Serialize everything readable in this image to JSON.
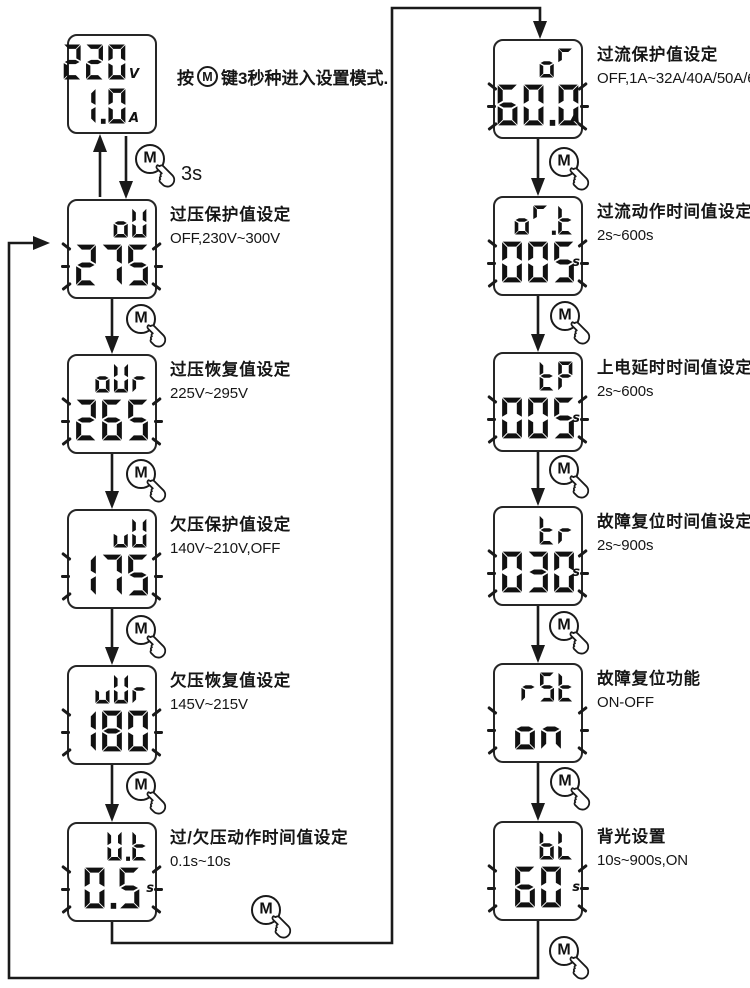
{
  "intro_note": {
    "prefix": "按",
    "m_label": "M",
    "suffix": "键3秒种进入设置模式."
  },
  "hold_time_label": "3s",
  "m_button_label": "M",
  "flow": {
    "home_screen": {
      "voltage": "220",
      "voltage_unit": "V",
      "current": "1.0",
      "current_unit": "A"
    },
    "left_steps": [
      {
        "screen_label": "oU",
        "screen_value": "275",
        "screen_unit": "",
        "blinking": true,
        "title": "过压保护值设定",
        "range": "OFF,230V~300V"
      },
      {
        "screen_label": "oUr",
        "screen_value": "265",
        "screen_unit": "",
        "blinking": true,
        "title": "过压恢复值设定",
        "range": "225V~295V"
      },
      {
        "screen_label": "uU",
        "screen_value": "175",
        "screen_unit": "",
        "blinking": true,
        "title": "欠压保护值设定",
        "range": "140V~210V,OFF"
      },
      {
        "screen_label": "uUr",
        "screen_value": "180",
        "screen_unit": "",
        "blinking": true,
        "title": "欠压恢复值设定",
        "range": "145V~215V"
      },
      {
        "screen_label": "U.t",
        "screen_value": "0.5",
        "screen_unit": "s",
        "blinking": true,
        "title": "过/欠压动作时间值设定",
        "range": "0.1s~10s"
      }
    ],
    "right_steps": [
      {
        "screen_label": "oC",
        "screen_value": "60.0",
        "screen_unit": "A",
        "blinking": true,
        "title": "过流保护值设定",
        "range": "OFF,1A~32A/40A/50A/63A"
      },
      {
        "screen_label": "oC.t",
        "screen_value": "005",
        "screen_unit": "s",
        "blinking": true,
        "title": "过流动作时间值设定",
        "range": "2s~600s"
      },
      {
        "screen_label": "tP",
        "screen_value": "005",
        "screen_unit": "s",
        "blinking": true,
        "title": "上电延时时间值设定",
        "range": "2s~600s"
      },
      {
        "screen_label": "tr",
        "screen_value": "030",
        "screen_unit": "s",
        "blinking": true,
        "title": "故障复位时间值设定",
        "range": "2s~900s"
      },
      {
        "screen_label": "rSt",
        "screen_value": "on",
        "screen_unit": "",
        "blinking": true,
        "title": "故障复位功能",
        "range": "ON-OFF"
      },
      {
        "screen_label": "bL",
        "screen_value": "60",
        "screen_unit": "s",
        "blinking": true,
        "title": "背光设置",
        "range": "10s~900s,ON"
      }
    ]
  },
  "colors": {
    "ink": "#1a1a1a",
    "background": "#ffffff"
  }
}
